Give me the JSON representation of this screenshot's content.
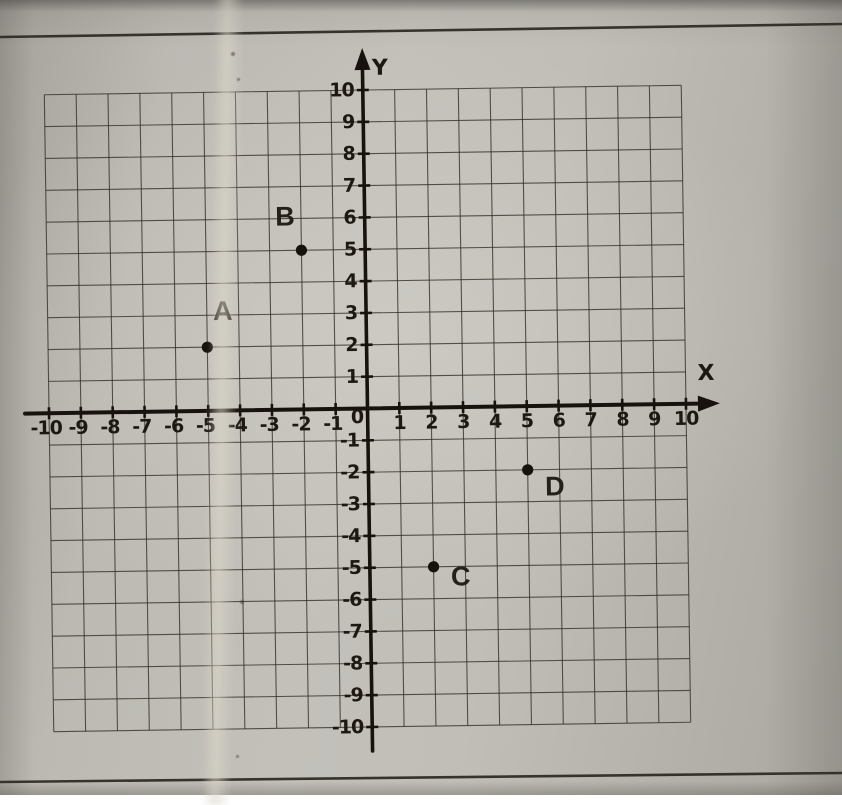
{
  "page": {
    "description": "Scanned worksheet photo of a coordinate plane with four labeled points",
    "paper_color": "#bcb9b3",
    "ink_color": "#17120d"
  },
  "chart_data": {
    "type": "scatter",
    "title": "",
    "xlabel": "X",
    "ylabel": "Y",
    "origin_label": "0",
    "xlim": [
      -10,
      10
    ],
    "ylim": [
      -10,
      10
    ],
    "grid": true,
    "grid_step": 1,
    "x_tick_labels": [
      -10,
      -9,
      -8,
      -7,
      -6,
      -5,
      -4,
      -3,
      -2,
      -1,
      1,
      2,
      3,
      4,
      5,
      6,
      7,
      8,
      9,
      10
    ],
    "y_tick_labels": [
      -10,
      -9,
      -8,
      -7,
      -6,
      -5,
      -4,
      -3,
      -2,
      -1,
      1,
      2,
      3,
      4,
      5,
      6,
      7,
      8,
      9,
      10
    ],
    "points": [
      {
        "label": "A",
        "x": -5,
        "y": 2,
        "label_offset": [
          16,
          -27
        ]
      },
      {
        "label": "B",
        "x": -2,
        "y": 5,
        "label_offset": [
          -16,
          -25
        ]
      },
      {
        "label": "C",
        "x": 2,
        "y": -5,
        "label_offset": [
          27,
          19
        ]
      },
      {
        "label": "D",
        "x": 5,
        "y": -2,
        "label_offset": [
          27,
          26
        ]
      }
    ],
    "point_color": "#16120e",
    "axis_color": "#17120d",
    "grid_color": "#332d26",
    "legend": null
  }
}
